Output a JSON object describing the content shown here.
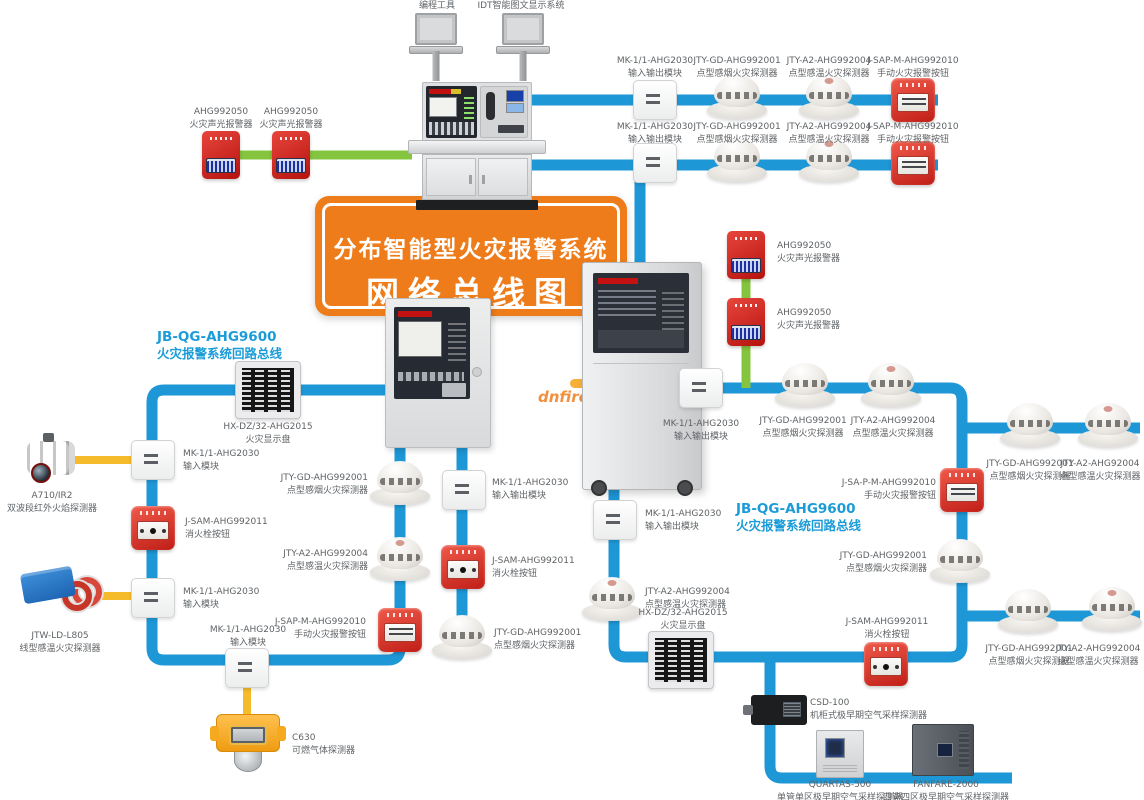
{
  "title": {
    "line1": "分布智能型火灾报警系统",
    "line2": "网络总线图"
  },
  "watermark": "dnfire.c",
  "colors": {
    "bus_blue": "#1e97d6",
    "bus_green": "#85c43f",
    "bus_yellow": "#f5bb2a",
    "banner_orange": "#ee7c1b",
    "label_gray": "#5f6366",
    "loop_label_blue": "#1b9cd8",
    "alarm_red": "#d6201d"
  },
  "loop_labels": {
    "left": {
      "code": "JB-QG-AHG9600",
      "desc": "火灾报警系统回路总线"
    },
    "right": {
      "code": "JB-QG-AHG9600",
      "desc": "火灾报警系统回路总线"
    }
  },
  "nodes": [
    {
      "name": "laptop-programming-tool",
      "type": "laptop",
      "x": 436,
      "y": 40,
      "label": {
        "lines": [
          "编程工具"
        ],
        "x": 437,
        "y": 0,
        "align": "center"
      }
    },
    {
      "name": "laptop-idt-display",
      "type": "laptop",
      "x": 523,
      "y": 40,
      "label": {
        "lines": [
          "IDT智能图文显示系统"
        ],
        "x": 521,
        "y": 0,
        "align": "center"
      }
    },
    {
      "name": "io-module-row1",
      "type": "module",
      "x": 655,
      "y": 100,
      "label": {
        "lines": [
          "MK-1/1-AHG2030",
          "输入输出模块"
        ],
        "x": 655,
        "y": 55,
        "align": "center"
      }
    },
    {
      "name": "smoke-detector-row1",
      "type": "smoke",
      "x": 737,
      "y": 98,
      "label": {
        "lines": [
          "JTY-GD-AHG992001",
          "点型感烟火灾探测器"
        ],
        "x": 737,
        "y": 55,
        "align": "center"
      }
    },
    {
      "name": "heat-detector-row1",
      "type": "temp",
      "x": 829,
      "y": 98,
      "label": {
        "lines": [
          "JTY-A2-AHG992004",
          "点型感温火灾探测器"
        ],
        "x": 829,
        "y": 55,
        "align": "center"
      }
    },
    {
      "name": "manual-call-point-row1",
      "type": "manual",
      "x": 913,
      "y": 100,
      "label": {
        "lines": [
          "J-SAP-M-AHG992010",
          "手动火灾报警按钮"
        ],
        "x": 913,
        "y": 55,
        "align": "center"
      }
    },
    {
      "name": "io-module-row2",
      "type": "module",
      "x": 655,
      "y": 163,
      "label": {
        "lines": [
          "MK-1/1-AHG2030",
          "输入输出模块"
        ],
        "x": 655,
        "y": 121,
        "align": "center"
      }
    },
    {
      "name": "smoke-detector-row2",
      "type": "smoke",
      "x": 737,
      "y": 161,
      "label": {
        "lines": [
          "JTY-GD-AHG992001",
          "点型感烟火灾探测器"
        ],
        "x": 737,
        "y": 121,
        "align": "center"
      }
    },
    {
      "name": "heat-detector-row2",
      "type": "temp",
      "x": 829,
      "y": 161,
      "label": {
        "lines": [
          "JTY-A2-AHG992004",
          "点型感温火灾探测器"
        ],
        "x": 829,
        "y": 121,
        "align": "center"
      }
    },
    {
      "name": "manual-call-point-row2",
      "type": "manual",
      "x": 913,
      "y": 163,
      "label": {
        "lines": [
          "J-SAP-M-AHG992010",
          "手动火灾报警按钮"
        ],
        "x": 913,
        "y": 121,
        "align": "center"
      }
    },
    {
      "name": "sounder-strobe-left-1",
      "type": "strobe",
      "x": 221,
      "y": 155,
      "label": {
        "lines": [
          "AHG992050",
          "火灾声光报警器"
        ],
        "x": 221,
        "y": 106,
        "align": "center"
      }
    },
    {
      "name": "sounder-strobe-left-2",
      "type": "strobe",
      "x": 291,
      "y": 155,
      "label": {
        "lines": [
          "AHG992050",
          "火灾声光报警器"
        ],
        "x": 291,
        "y": 106,
        "align": "center"
      }
    },
    {
      "name": "sounder-strobe-right-1",
      "type": "strobe",
      "x": 746,
      "y": 255,
      "label": {
        "lines": [
          "AHG992050",
          "火灾声光报警器"
        ],
        "x": 777,
        "y": 240,
        "align": "left"
      }
    },
    {
      "name": "sounder-strobe-right-2",
      "type": "strobe",
      "x": 746,
      "y": 322,
      "label": {
        "lines": [
          "AHG992050",
          "火灾声光报警器"
        ],
        "x": 777,
        "y": 307,
        "align": "left"
      }
    },
    {
      "name": "fire-display-panel-left",
      "type": "display",
      "x": 268,
      "y": 390,
      "label": {
        "lines": [
          "HX-DZ/32-AHG2015",
          "火灾显示盘"
        ],
        "x": 268,
        "y": 421,
        "align": "center"
      }
    },
    {
      "name": "input-module-left-1",
      "type": "module",
      "x": 153,
      "y": 460,
      "label": {
        "lines": [
          "MK-1/1-AHG2030",
          "输入模块"
        ],
        "x": 183,
        "y": 448,
        "align": "left"
      }
    },
    {
      "name": "hydrant-button-left",
      "type": "hydrant",
      "x": 153,
      "y": 528,
      "label": {
        "lines": [
          "J-SAM-AHG992011",
          "消火栓按钮"
        ],
        "x": 185,
        "y": 516,
        "align": "left"
      }
    },
    {
      "name": "input-module-left-2",
      "type": "module",
      "x": 153,
      "y": 598,
      "label": {
        "lines": [
          "MK-1/1-AHG2030",
          "输入模块"
        ],
        "x": 183,
        "y": 586,
        "align": "left"
      }
    },
    {
      "name": "flame-detector",
      "type": "flame",
      "x": 52,
      "y": 458,
      "label": {
        "lines": [
          "A710/IR2",
          "双波段红外火焰探测器"
        ],
        "x": 52,
        "y": 490,
        "align": "center"
      }
    },
    {
      "name": "linear-heat-detector",
      "type": "linear",
      "x": 62,
      "y": 592,
      "label": {
        "lines": [
          "JTW-LD-L805",
          "线型感温火灾探测器"
        ],
        "x": 60,
        "y": 630,
        "align": "center"
      }
    },
    {
      "name": "input-module-bottom",
      "type": "module",
      "x": 247,
      "y": 668,
      "label": {
        "lines": [
          "MK-1/1-AHG2030",
          "输入模块"
        ],
        "x": 248,
        "y": 624,
        "align": "center"
      }
    },
    {
      "name": "gas-detector",
      "type": "gas",
      "x": 248,
      "y": 740,
      "label": {
        "lines": [
          "C630",
          "可燃气体探测器"
        ],
        "x": 292,
        "y": 732,
        "align": "left"
      }
    },
    {
      "name": "smoke-detector-loop1-1",
      "type": "smoke",
      "x": 400,
      "y": 484,
      "label": {
        "lines": [
          "JTY-GD-AHG992001",
          "点型感烟火灾探测器"
        ],
        "x": 368,
        "y": 472,
        "align": "right"
      }
    },
    {
      "name": "heat-detector-loop1",
      "type": "temp",
      "x": 400,
      "y": 560,
      "label": {
        "lines": [
          "JTY-A2-AHG992004",
          "点型感温火灾探测器"
        ],
        "x": 368,
        "y": 548,
        "align": "right"
      }
    },
    {
      "name": "manual-call-point-loop1",
      "type": "manual",
      "x": 400,
      "y": 630,
      "label": {
        "lines": [
          "J-SAP-M-AHG992010",
          "手动火灾报警按钮"
        ],
        "x": 366,
        "y": 616,
        "align": "right"
      }
    },
    {
      "name": "io-module-loop1",
      "type": "module",
      "x": 464,
      "y": 490,
      "label": {
        "lines": [
          "MK-1/1-AHG2030",
          "输入输出模块"
        ],
        "x": 492,
        "y": 477,
        "align": "left"
      }
    },
    {
      "name": "hydrant-button-loop1",
      "type": "hydrant",
      "x": 463,
      "y": 567,
      "label": {
        "lines": [
          "J-SAM-AHG992011",
          "消火栓按钮"
        ],
        "x": 492,
        "y": 555,
        "align": "left"
      }
    },
    {
      "name": "smoke-detector-loop1-2",
      "type": "smoke",
      "x": 462,
      "y": 638,
      "label": {
        "lines": [
          "JTY-GD-AHG992001",
          "点型感烟火灾探测器"
        ],
        "x": 494,
        "y": 627,
        "align": "left"
      }
    },
    {
      "name": "io-module-loop2-1",
      "type": "module",
      "x": 615,
      "y": 520,
      "label": {
        "lines": [
          "MK-1/1-AHG2030",
          "输入输出模块"
        ],
        "x": 645,
        "y": 508,
        "align": "left"
      }
    },
    {
      "name": "heat-detector-loop2-1",
      "type": "temp",
      "x": 612,
      "y": 600,
      "label": {
        "lines": [
          "JTY-A2-AHG992004",
          "点型感温火灾探测器"
        ],
        "x": 645,
        "y": 586,
        "align": "left"
      }
    },
    {
      "name": "fire-display-panel-right",
      "type": "display",
      "x": 681,
      "y": 660,
      "label": {
        "lines": [
          "HX-DZ/32-AHG2015",
          "火灾显示盘"
        ],
        "x": 683,
        "y": 607,
        "align": "center"
      }
    },
    {
      "name": "io-module-loop2-2",
      "type": "module",
      "x": 701,
      "y": 388,
      "label": {
        "lines": [
          "MK-1/1-AHG2030",
          "输入输出模块"
        ],
        "x": 701,
        "y": 418,
        "align": "center"
      }
    },
    {
      "name": "smoke-detector-loop2-1",
      "type": "smoke",
      "x": 805,
      "y": 386,
      "label": {
        "lines": [
          "JTY-GD-AHG992001",
          "点型感烟火灾探测器"
        ],
        "x": 803,
        "y": 415,
        "align": "center"
      }
    },
    {
      "name": "heat-detector-loop2-2",
      "type": "temp",
      "x": 891,
      "y": 386,
      "label": {
        "lines": [
          "JTY-A2-AHG992004",
          "点型感温火灾探测器"
        ],
        "x": 893,
        "y": 415,
        "align": "center"
      }
    },
    {
      "name": "manual-call-point-loop2",
      "type": "manual",
      "x": 962,
      "y": 490,
      "label": {
        "lines": [
          "J-SA-P-M-AHG992010",
          "手动火灾报警按钮"
        ],
        "x": 936,
        "y": 477,
        "align": "right"
      }
    },
    {
      "name": "smoke-detector-loop2-2",
      "type": "smoke",
      "x": 960,
      "y": 562,
      "label": {
        "lines": [
          "JTY-GD-AHG992001",
          "点型感烟火灾探测器"
        ],
        "x": 927,
        "y": 550,
        "align": "right"
      }
    },
    {
      "name": "hydrant-button-loop2",
      "type": "hydrant",
      "x": 886,
      "y": 664,
      "label": {
        "lines": [
          "J-SAM-AHG992011",
          "消火栓按钮"
        ],
        "x": 887,
        "y": 616,
        "align": "center"
      }
    },
    {
      "name": "smoke-detector-right-top",
      "type": "smoke",
      "x": 1030,
      "y": 426,
      "label": {
        "lines": [
          "JTY-GD-AHG992001",
          "点型感烟火灾探测器"
        ],
        "x": 1030,
        "y": 458,
        "align": "center"
      }
    },
    {
      "name": "heat-detector-right-top",
      "type": "temp",
      "x": 1108,
      "y": 426,
      "label": {
        "lines": [
          "JTY-A2-AHG92004",
          "点型感温火灾探测器"
        ],
        "x": 1100,
        "y": 458,
        "align": "center"
      }
    },
    {
      "name": "smoke-detector-right-bottom",
      "type": "smoke",
      "x": 1028,
      "y": 612,
      "label": {
        "lines": [
          "JTY-GD-AHG992001",
          "点型感烟火灾探测器"
        ],
        "x": 1029,
        "y": 643,
        "align": "center"
      }
    },
    {
      "name": "heat-detector-right-bottom",
      "type": "temp",
      "x": 1112,
      "y": 610,
      "label": {
        "lines": [
          "JTY-A2-AHG992004",
          "点型感温火灾探测器"
        ],
        "x": 1098,
        "y": 643,
        "align": "center"
      }
    },
    {
      "name": "air-sampling-csd100",
      "type": "csd",
      "x": 779,
      "y": 710,
      "label": {
        "lines": [
          "CSD-100",
          "机柜式极早期空气采样探测器"
        ],
        "x": 810,
        "y": 697,
        "align": "left"
      }
    },
    {
      "name": "air-sampling-quartas500",
      "type": "wallbox",
      "x": 840,
      "y": 754,
      "label": {
        "lines": [
          "QUARTAS-500",
          "单管单区极早期空气采样探测器"
        ],
        "x": 840,
        "y": 779,
        "align": "center"
      }
    },
    {
      "name": "air-sampling-fanfare2000",
      "type": "bigbox",
      "x": 943,
      "y": 750,
      "label": {
        "lines": [
          "FANFARE-2000",
          "四管四区极早期空气采样探测器"
        ],
        "x": 946,
        "y": 779,
        "align": "center"
      }
    }
  ]
}
